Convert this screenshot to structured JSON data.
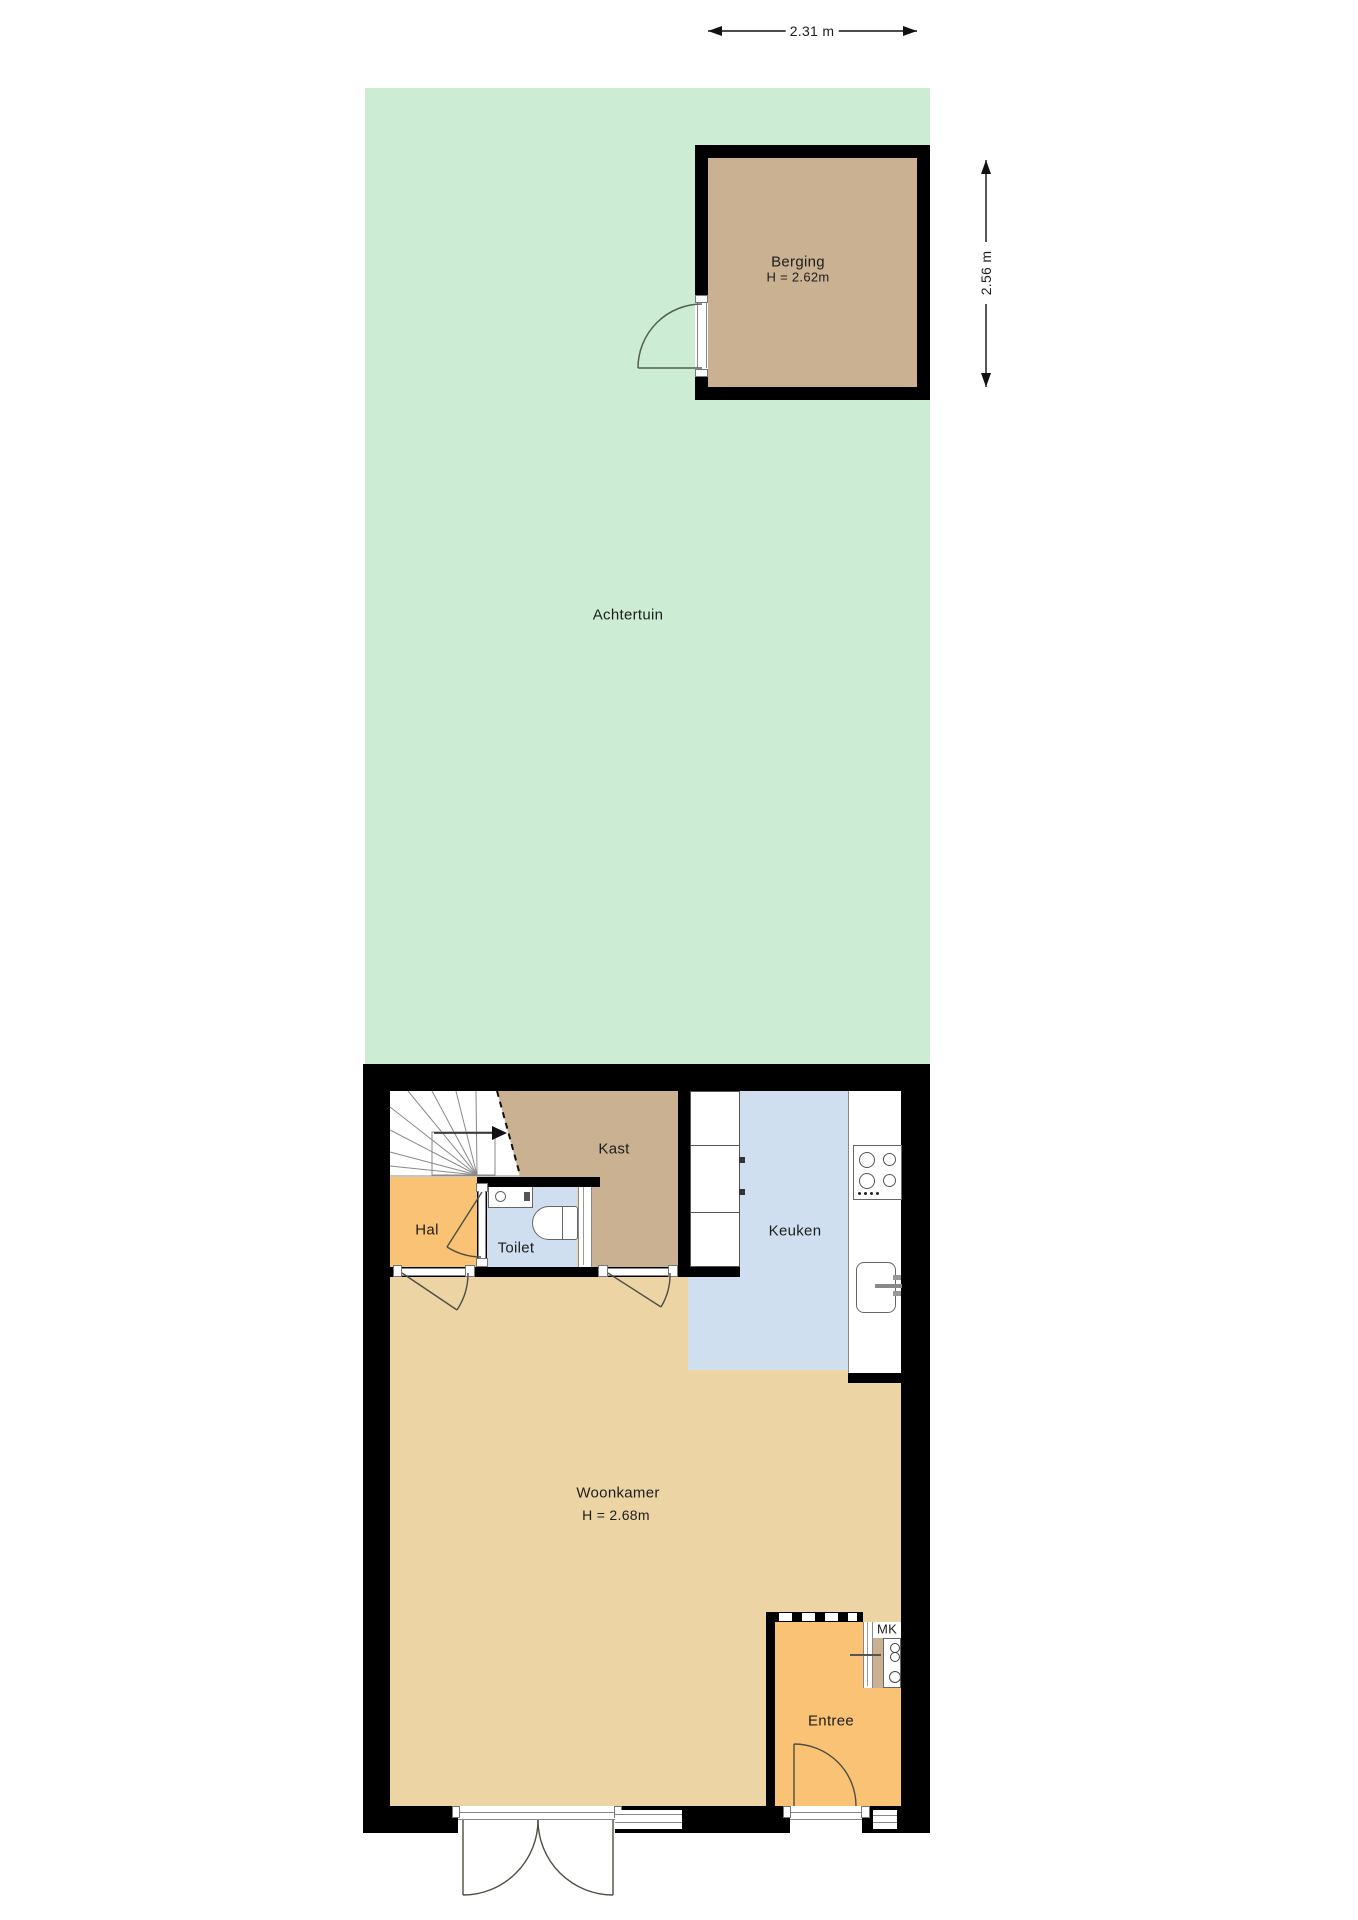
{
  "plan": {
    "garden": {
      "label": "Achtertuin"
    },
    "berging": {
      "label": "Berging",
      "height_label": "H = 2.62m"
    },
    "rooms": {
      "kast": "Kast",
      "hal": "Hal",
      "toilet": "Toilet",
      "keuken": "Keuken",
      "woonkamer": "Woonkamer",
      "woonkamer_height": "H = 2.68m",
      "entree": "Entree",
      "mk": "MK"
    },
    "dimensions": {
      "berging_width": "2.31 m",
      "berging_depth": "2.56 m"
    },
    "colors": {
      "garden_green": "#ccedd3",
      "storage_brown": "#c9b191",
      "hall_orange": "#f9c274",
      "living_tan": "#edd4a5",
      "wet_room_blue": "#cfdff0",
      "wall_black": "#000000"
    }
  }
}
